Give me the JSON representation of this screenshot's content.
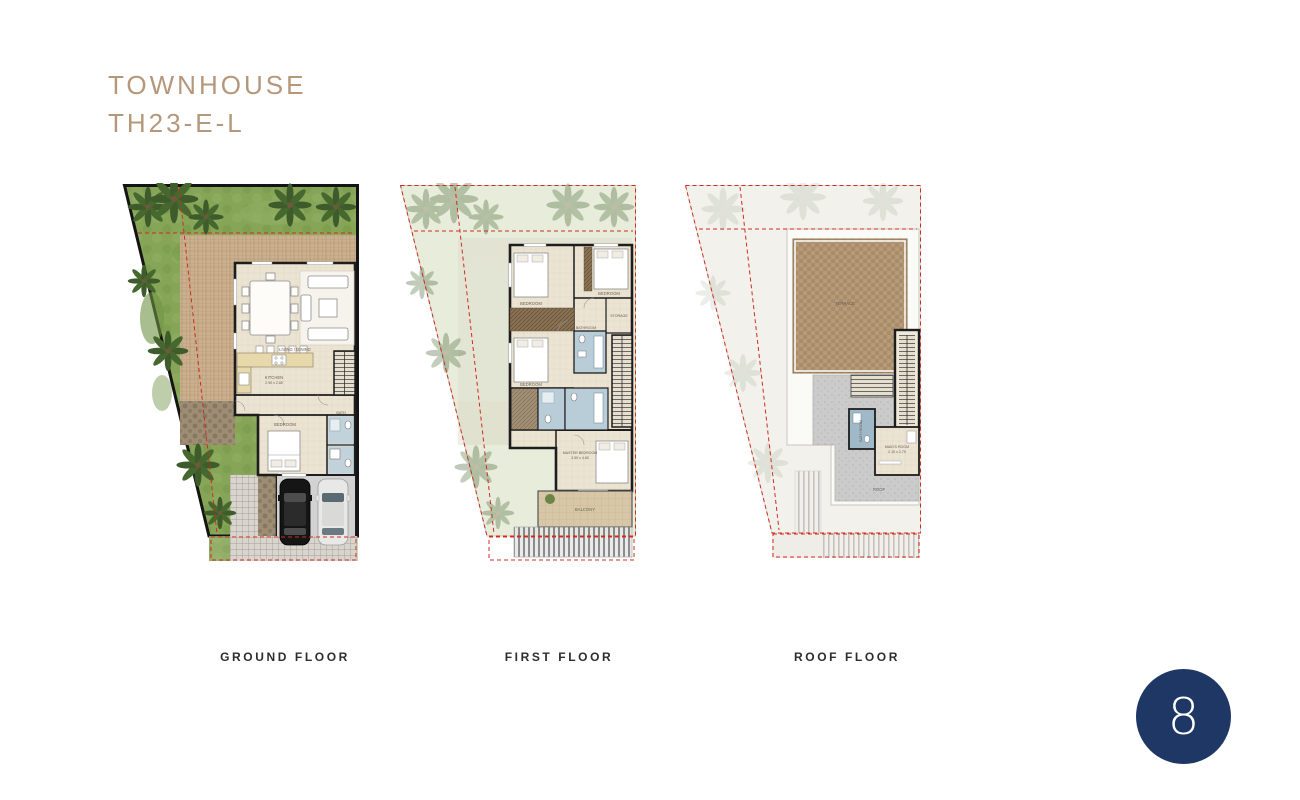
{
  "title": {
    "line1": "TOWNHOUSE",
    "line2": "TH23-E-L"
  },
  "badge": {
    "number": "8"
  },
  "colors": {
    "title_text": "#b5977a",
    "floor_label_text": "#2d2d2d",
    "badge_background": "#1e3765",
    "boundary_dash_red": "#d02c20",
    "grass_green": "#86a557",
    "patio_tan": "#cbb08f",
    "terrace_brown": "#b69a79",
    "wall_black": "#1d1d1d"
  },
  "floors": [
    {
      "label": "GROUND FLOOR",
      "rooms": {
        "living": {
          "label": "LIVING / DINING"
        },
        "kitchen": {
          "label": "KITCHEN",
          "dims": "2.90 x 2.80"
        },
        "bedroom": {
          "label": "BEDROOM"
        },
        "bath": {
          "label": "BATH"
        }
      }
    },
    {
      "label": "FIRST FLOOR",
      "rooms": {
        "bedroom1": {
          "label": "BEDROOM"
        },
        "bedroom2": {
          "label": "BEDROOM"
        },
        "bedroom3": {
          "label": "BEDROOM"
        },
        "storage": {
          "label": "STORAGE"
        },
        "bathroom": {
          "label": "BATHROOM"
        },
        "master": {
          "label": "MASTER BEDROOM",
          "dims": "3.50 x 4.80"
        },
        "balcony": {
          "label": "BALCONY"
        }
      }
    },
    {
      "label": "ROOF FLOOR",
      "rooms": {
        "terrace": {
          "label": "TERRACE"
        },
        "bathroom": {
          "label": "BATH ROOM"
        },
        "maid": {
          "label": "MAID'S ROOM",
          "dims": "2.10 x 2.79"
        },
        "roof": {
          "label": "ROOF"
        }
      }
    }
  ]
}
